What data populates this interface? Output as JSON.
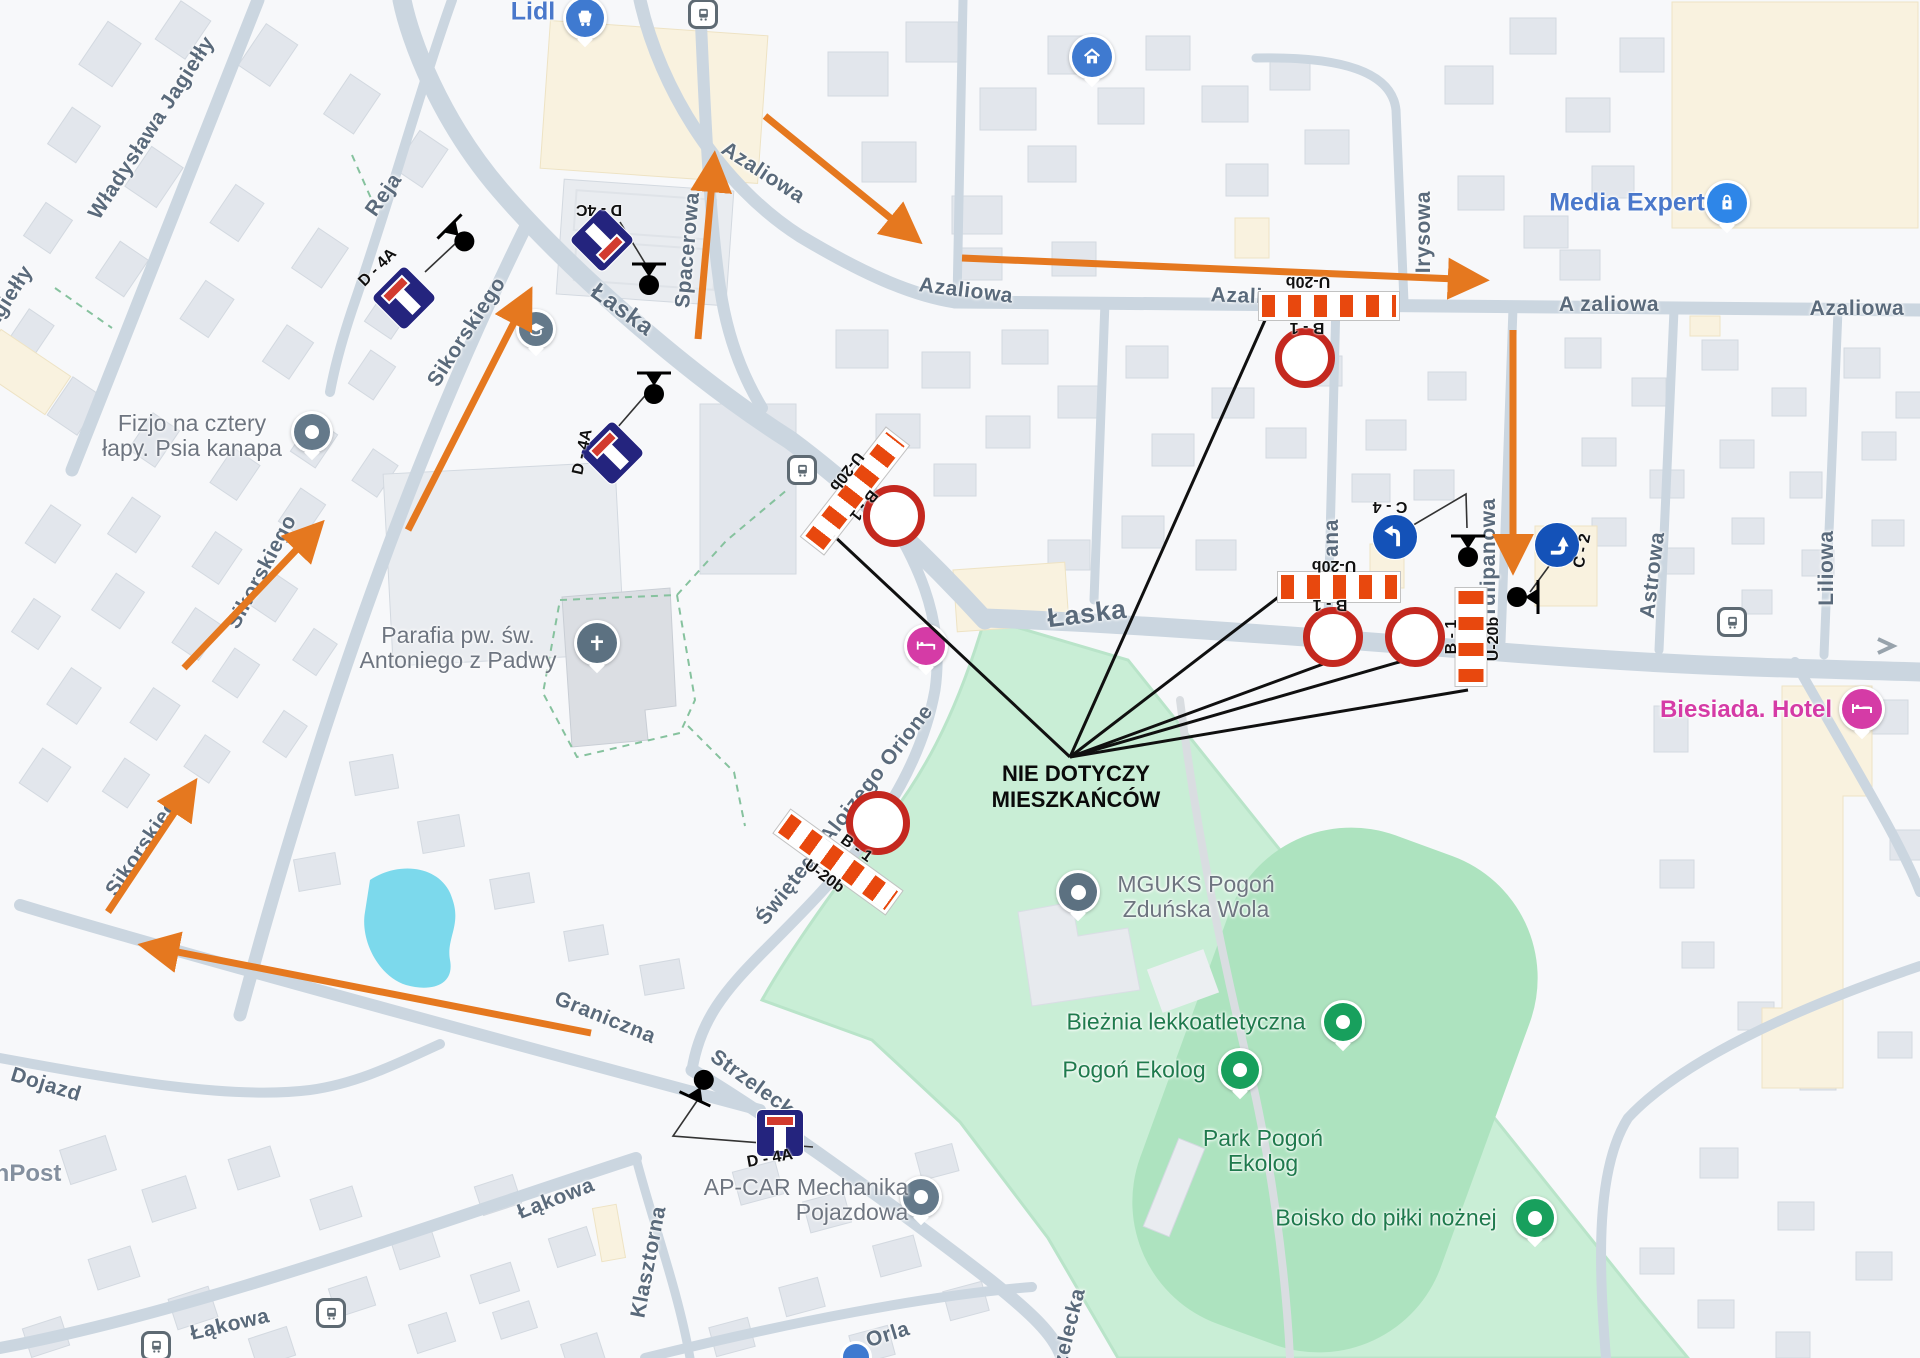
{
  "streets": {
    "wladyslawa_jagielly": "Władysława Jagiełły",
    "jagielly_corner": "Jagiełły",
    "reja": "Reja",
    "laska_nw": "Łaska",
    "laska_c": "Łaska",
    "sikorskiego_n": "Sikorskiego",
    "sikorskiego_m": "Sikorskiego",
    "sikorskiego_s": "Sikorskiego",
    "spacerowa": "Spacerowa",
    "azaliowa_nw": "Azaliowa",
    "azaliowa_w": "Azaliowa",
    "azaliowa_c": "Azaliowa",
    "azaliowa_e1": "A zaliowa",
    "azaliowa_e2": "Azaliowa",
    "irysowa": "Irysowa",
    "street_ana": "ana",
    "tulipanowa": "Tulipanowa",
    "astrowa": "Astrowa",
    "liliowa": "Liliowa",
    "swietego_alojzego": "Świętego Alojzego Orione",
    "graniczna": "Graniczna",
    "strzelecka_n": "Strzelecka",
    "strzelecka_s": "Strzelecka",
    "dojazd": "Dojazd",
    "lakowa_n": "Łąkowa",
    "lakowa_s": "Łąkowa",
    "klasztorna": "Klasztorna",
    "orla": "Orla"
  },
  "pois": {
    "lidl": "Lidl",
    "media_expert": "Media Expert",
    "fizjo_line1": "Fizjo na cztery",
    "fizjo_line2": "łapy. Psia kanapa",
    "parafia_line1": "Parafia pw. św.",
    "parafia_line2": "Antoniego z Padwy",
    "biesiada": "Biesiada. Hotel",
    "mguks_line1": "MGUKS Pogoń",
    "mguks_line2": "Zduńska Wola",
    "bieznia": "Bieżnia lekkoatletyczna",
    "pogon_ekolog": "Pogoń Ekolog",
    "park_pogon_line1": "Park Pogoń",
    "park_pogon_line2": "Ekolog",
    "boisko": "Boisko do piłki nożnej",
    "apcar_line1": "AP-CAR Mechanika",
    "apcar_line2": "Pojazdowa",
    "npost": "nPost"
  },
  "signs": {
    "b1": "B - 1",
    "u20b": "U-20b",
    "d4a": "D - 4A",
    "d4c": "D - 4C",
    "c2": "C - 2",
    "c4": "C - 4"
  },
  "note": {
    "line1": "NIE DOTYCZY",
    "line2": "MIESZKAŃCÓW"
  },
  "colors": {
    "annotation_orange": "#E5781F",
    "barrier_orange": "#E8480E",
    "prohibition_red": "#C4281F",
    "sign_navy": "#24247E",
    "sign_blue": "#1452B8",
    "park_green": "#C9EED6",
    "water_blue": "#7CD9EC",
    "poi_pink": "#D53BA6",
    "poi_blue": "#4A78CB",
    "poi_green": "#1F7A4D"
  }
}
